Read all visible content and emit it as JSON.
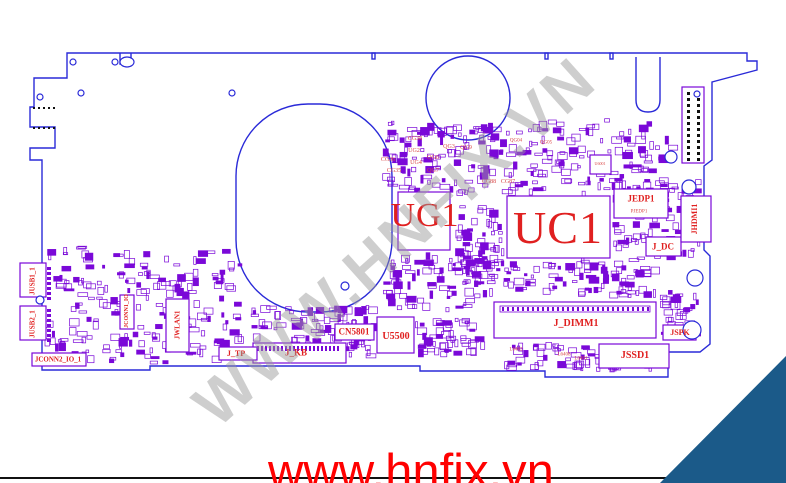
{
  "watermark": {
    "text": "WWW.HNFIX.VN",
    "color": "#9a9a9a"
  },
  "footer": {
    "url": "www.hnfix.vn",
    "color": "#ff0000"
  },
  "ribbon": {
    "text_head": "HNFI",
    "text_x": "X",
    "text_tail": ".VN",
    "bg": "#1b5a89",
    "fg": "#d8e8f4",
    "slash_color": "#e02020"
  },
  "board": {
    "outline_color": "#2a2ad8",
    "component_color": "#7a08d8",
    "label_color": "#e02020",
    "labels": [
      {
        "t": "UG1",
        "x": 425,
        "y": 216,
        "s": 34,
        "cls": "lbl-big"
      },
      {
        "t": "UC1",
        "x": 558,
        "y": 228,
        "s": 46,
        "cls": "lbl-big"
      },
      {
        "t": "J_DIMM1",
        "x": 576,
        "y": 324,
        "s": 10,
        "cls": "lbl-med"
      },
      {
        "t": "JSSD1",
        "x": 635,
        "y": 356,
        "s": 10,
        "cls": "lbl-med"
      },
      {
        "t": "U5500",
        "x": 396,
        "y": 337,
        "s": 10,
        "cls": "lbl-med"
      },
      {
        "t": "CN5801",
        "x": 354,
        "y": 332,
        "s": 9,
        "cls": "lbl-med"
      },
      {
        "t": "JEDP1",
        "x": 641,
        "y": 199,
        "s": 9,
        "cls": "lbl-med"
      },
      {
        "t": "J_DC",
        "x": 663,
        "y": 247,
        "s": 9,
        "cls": "lbl-med"
      },
      {
        "t": "J_KB",
        "x": 296,
        "y": 353,
        "s": 9,
        "cls": "lbl-med"
      },
      {
        "t": "J_TP",
        "x": 236,
        "y": 354,
        "s": 8,
        "cls": "lbl-med"
      },
      {
        "t": "JSPK",
        "x": 680,
        "y": 333,
        "s": 8,
        "cls": "lbl-med"
      },
      {
        "t": "JCONN2_IO_1",
        "x": 58,
        "y": 360,
        "s": 7,
        "cls": "lbl-med"
      },
      {
        "t": "JHDMI1",
        "x": 695,
        "y": 219,
        "s": 8,
        "r": -90,
        "cls": "lbl-med"
      },
      {
        "t": "JWLAN1",
        "x": 178,
        "y": 325,
        "s": 7,
        "r": -90,
        "cls": "lbl-med"
      },
      {
        "t": "JUSB1_1",
        "x": 33,
        "y": 281,
        "s": 7,
        "r": -90,
        "cls": "lbl-med"
      },
      {
        "t": "JUSB2_1",
        "x": 33,
        "y": 324,
        "s": 7,
        "r": -90,
        "cls": "lbl-med"
      },
      {
        "t": "JCONN1_IO",
        "x": 127,
        "y": 311,
        "s": 6,
        "r": -90,
        "cls": "lbl-med"
      },
      {
        "t": "CG38",
        "x": 415,
        "y": 139,
        "s": 6,
        "cls": "lbl-small"
      },
      {
        "t": "UG2",
        "x": 414,
        "y": 151,
        "s": 6,
        "cls": "lbl-small"
      },
      {
        "t": "UG4",
        "x": 416,
        "y": 163,
        "s": 6,
        "cls": "lbl-small"
      },
      {
        "t": "QG3",
        "x": 449,
        "y": 147,
        "s": 6,
        "cls": "lbl-small"
      },
      {
        "t": "QG9",
        "x": 466,
        "y": 148,
        "s": 6,
        "cls": "lbl-small"
      },
      {
        "t": "QG6",
        "x": 433,
        "y": 158,
        "s": 6,
        "cls": "lbl-small"
      },
      {
        "t": "QG7",
        "x": 433,
        "y": 171,
        "s": 6,
        "cls": "lbl-small"
      },
      {
        "t": "CG36",
        "x": 388,
        "y": 160,
        "s": 6,
        "cls": "lbl-small"
      },
      {
        "t": "CG35",
        "x": 394,
        "y": 171,
        "s": 6,
        "cls": "lbl-small"
      },
      {
        "t": "CG88",
        "x": 489,
        "y": 182,
        "s": 6,
        "cls": "lbl-small"
      },
      {
        "t": "CG87",
        "x": 508,
        "y": 182,
        "s": 6,
        "cls": "lbl-small"
      },
      {
        "t": "QG04",
        "x": 516,
        "y": 141,
        "s": 5,
        "cls": "lbl-small"
      },
      {
        "t": "QG05",
        "x": 546,
        "y": 143,
        "s": 5,
        "cls": "lbl-small"
      },
      {
        "t": "U6001",
        "x": 600,
        "y": 164,
        "s": 4,
        "cls": "lbl-small"
      },
      {
        "t": "PJEDP1",
        "x": 639,
        "y": 212,
        "s": 5,
        "cls": "lbl-small"
      },
      {
        "t": "L6402",
        "x": 516,
        "y": 350,
        "s": 5,
        "cls": "lbl-small"
      },
      {
        "t": "L6408",
        "x": 564,
        "y": 355,
        "s": 5,
        "cls": "lbl-small"
      },
      {
        "t": "L6401",
        "x": 581,
        "y": 359,
        "s": 5,
        "cls": "lbl-small"
      }
    ],
    "clusters": [
      {
        "x": 382,
        "y": 118,
        "w": 296,
        "h": 80,
        "n": 240
      },
      {
        "x": 455,
        "y": 198,
        "w": 50,
        "h": 88,
        "n": 70
      },
      {
        "x": 382,
        "y": 252,
        "w": 100,
        "h": 60,
        "n": 70
      },
      {
        "x": 480,
        "y": 258,
        "w": 180,
        "h": 40,
        "n": 90
      },
      {
        "x": 44,
        "y": 246,
        "w": 200,
        "h": 118,
        "n": 200
      },
      {
        "x": 250,
        "y": 305,
        "w": 128,
        "h": 58,
        "n": 100
      },
      {
        "x": 612,
        "y": 176,
        "w": 90,
        "h": 84,
        "n": 80
      },
      {
        "x": 498,
        "y": 342,
        "w": 160,
        "h": 30,
        "n": 70
      },
      {
        "x": 660,
        "y": 286,
        "w": 42,
        "h": 52,
        "n": 34
      },
      {
        "x": 415,
        "y": 318,
        "w": 70,
        "h": 40,
        "n": 50
      }
    ],
    "pin_rows": [
      {
        "x": 47,
        "y": 267,
        "dx": 0,
        "dy": 5,
        "n": 7,
        "w": 4,
        "h": 3
      },
      {
        "x": 47,
        "y": 309,
        "dx": 0,
        "dy": 5,
        "n": 7,
        "w": 4,
        "h": 3
      },
      {
        "x": 257,
        "y": 346,
        "dx": 4,
        "dy": 0,
        "n": 21,
        "w": 2,
        "h": 5
      },
      {
        "x": 502,
        "y": 307,
        "dx": 5,
        "dy": 0,
        "n": 30,
        "w": 2,
        "h": 4
      },
      {
        "x": 687,
        "y": 92,
        "dx": 0,
        "dy": 6,
        "n": 12,
        "w": 3,
        "h": 3,
        "fill": "#111111"
      },
      {
        "x": 697,
        "y": 92,
        "dx": 0,
        "dy": 6,
        "n": 12,
        "w": 3,
        "h": 3,
        "fill": "#111111"
      },
      {
        "x": 33,
        "y": 107,
        "dx": 5,
        "dy": 0,
        "n": 5,
        "w": 2,
        "h": 2,
        "fill": "#111111"
      },
      {
        "x": 33,
        "y": 127,
        "dx": 5,
        "dy": 0,
        "n": 5,
        "w": 2,
        "h": 2,
        "fill": "#111111"
      }
    ]
  }
}
